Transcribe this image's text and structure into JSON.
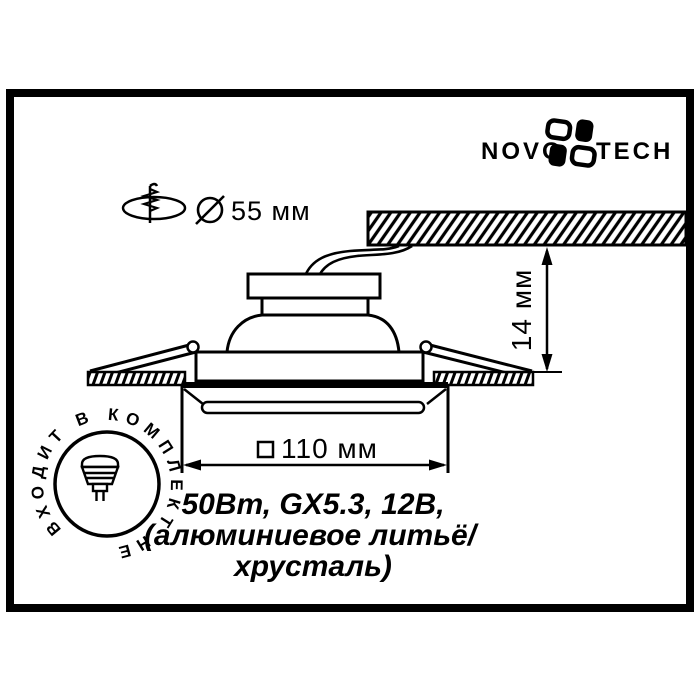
{
  "page": {
    "background": "#ffffff",
    "ink": "#000000",
    "type": "technical-drawing"
  },
  "brand": {
    "name_left": "NOVO",
    "name_right": "TECH",
    "icon": "novotech-pinwheel-icon"
  },
  "cutout_note": {
    "icon": "ceiling-hole-drill-icon",
    "diameter_symbol_icon": "diameter-symbol-icon",
    "value": "55 мм"
  },
  "recess_depth": {
    "value": "14 мм"
  },
  "face_width": {
    "symbol_icon": "square-symbol-icon",
    "value": "110 мм"
  },
  "specs": {
    "line1": "50Вт, GX5.3, 12В,",
    "line2": "(алюминиевое литьё/",
    "line3": "хрусталь)"
  },
  "lamp_badge": {
    "text_display": "НЕ ВХОДИТ В КОМПЛЕКТ",
    "text_path_order": "ВХОДИТ В КОМПЛЕКТ НЕ",
    "icon": "mr16-lamp-icon"
  }
}
